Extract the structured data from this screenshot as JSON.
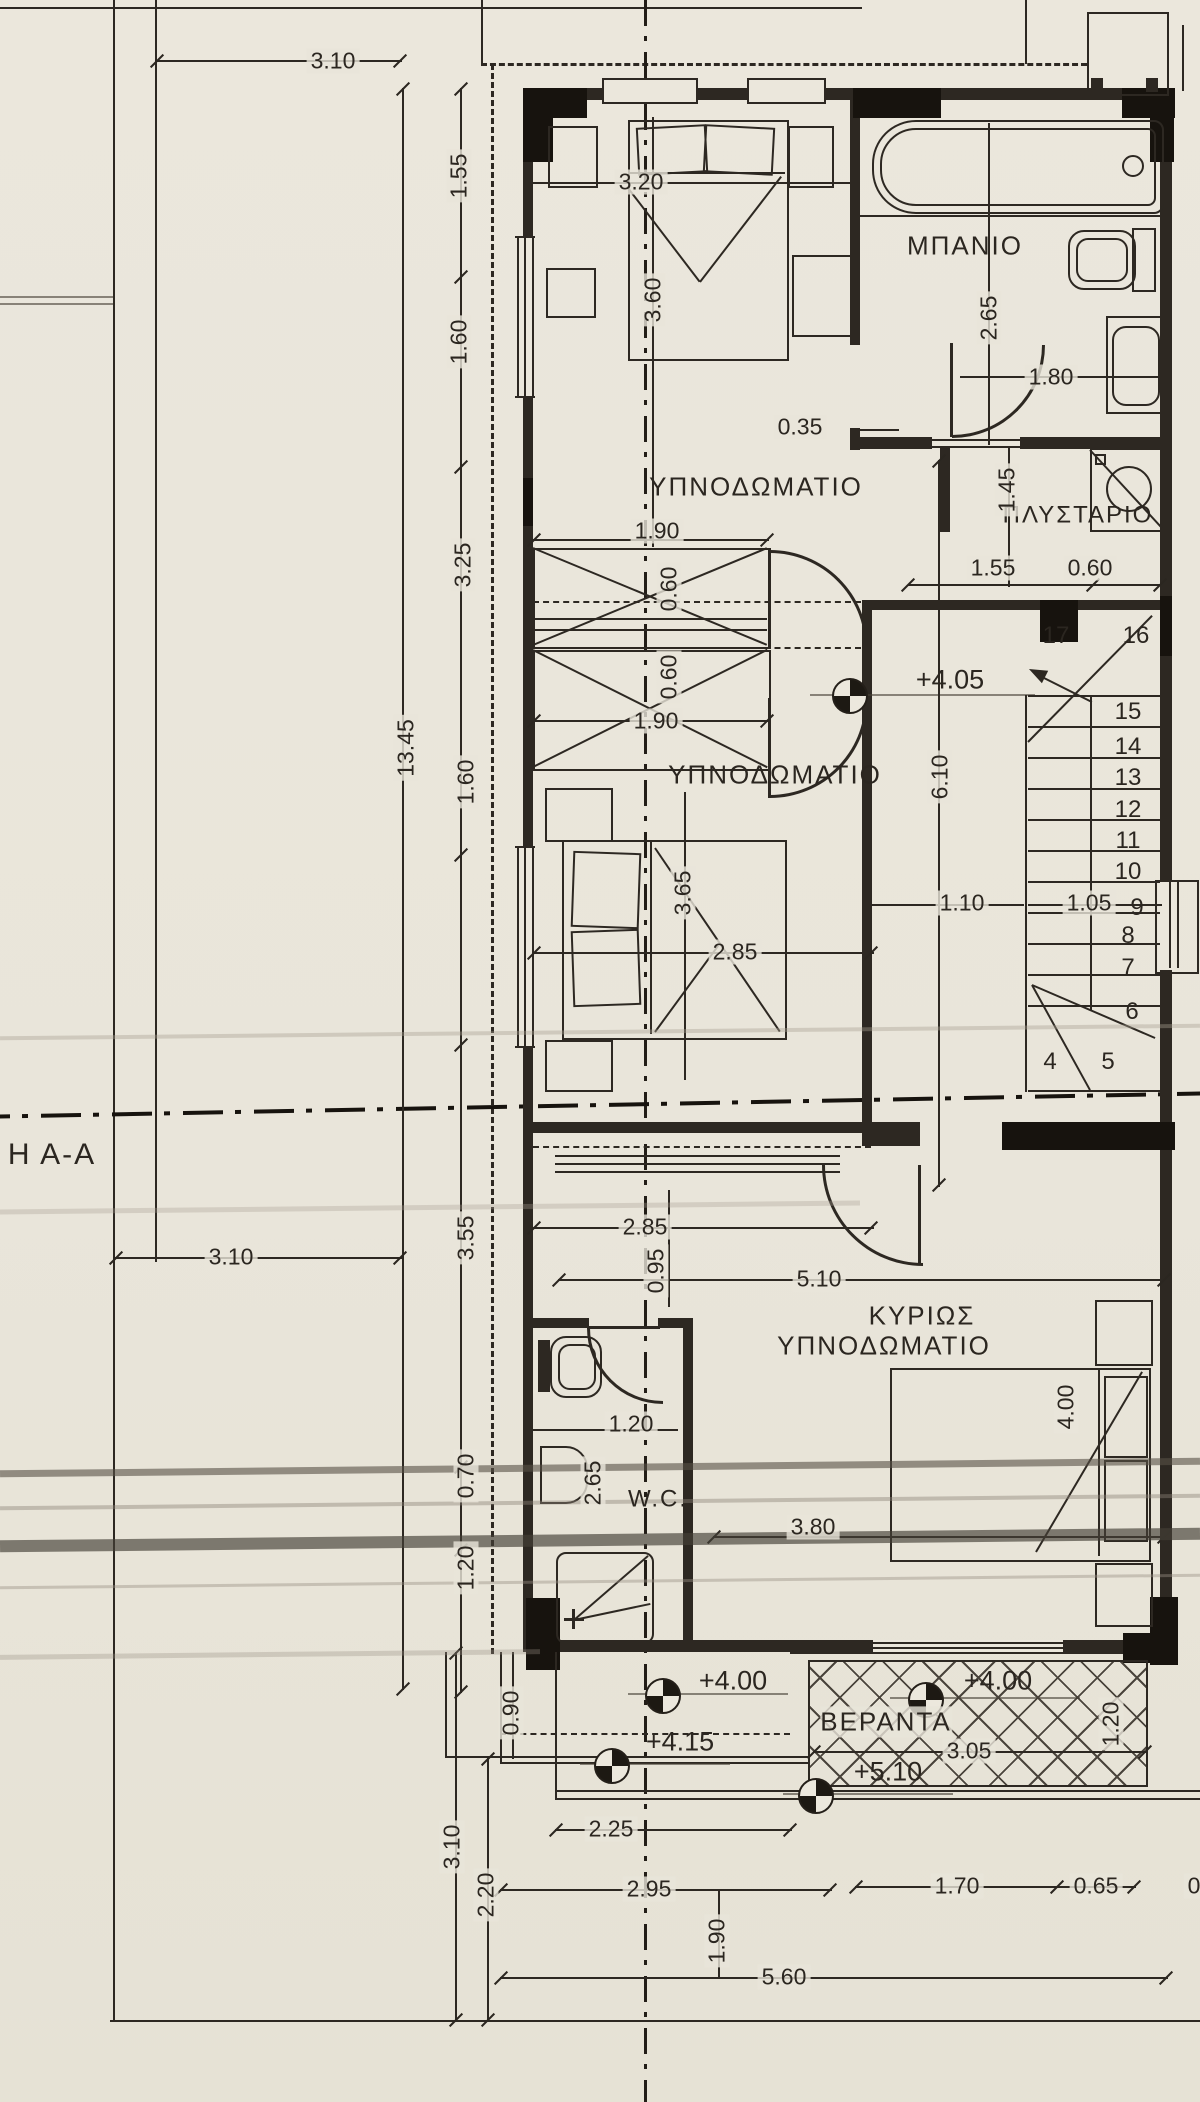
{
  "section_label": "Η Α-Α",
  "rooms": {
    "bedroom_top": "ΥΠΝΟΔΩΜΑΤΙΟ",
    "bedroom_mid": "ΥΠΝΟΔΩΜΑΤΙΟ",
    "bathroom": "ΜΠΑΝΙΟ",
    "laundry": "ΠΛΥΣΤΑΡΙΟ",
    "main_bedroom_line1": "ΚΥΡΙΩΣ",
    "main_bedroom_line2": "ΥΠΝΟΔΩΜΑΤΙΟ",
    "wc": "W.C.",
    "veranda": "ΒΕΡΑΝΤΑ"
  },
  "levels": {
    "hall": "+4.05",
    "exterior": "+4.00",
    "exterior_step": "+4.15",
    "veranda": "+4.00",
    "veranda_lower": "+5.10"
  },
  "stairs": [
    "4",
    "5",
    "6",
    "7",
    "8",
    "9",
    "10",
    "11",
    "12",
    "13",
    "14",
    "15",
    "16",
    "17"
  ],
  "dims": {
    "top_width": "3.10",
    "chain_1_55": "1.55",
    "chain_1_60a": "1.60",
    "chain_3_25": "3.25",
    "chain_13_45": "13.45",
    "chain_1_60b": "1.60",
    "chain_3_55": "3.55",
    "chain_0_70": "0.70",
    "chain_1_20": "1.20",
    "left_bottom": "3.10",
    "bed1_width": "3.20",
    "bed1_length": "3.60",
    "bath_depth": "2.65",
    "bath_width": "1.80",
    "wall_nib": "0.35",
    "laundry_depth": "1.45",
    "laundry_width": "1.55",
    "laundry_right": "0.60",
    "closet1_width": "1.90",
    "closet1_depth": "0.60",
    "closet2_depth": "0.60",
    "closet2_width": "1.90",
    "bed2_length": "3.65",
    "bedroom2_width": "2.85",
    "stair_length": "6.10",
    "hall_width": "1.10",
    "stair_width": "1.05",
    "hall_lower_width": "2.85",
    "hall_lower_depth": "0.95",
    "main_width": "5.10",
    "main_inner": "3.80",
    "main_bed_length": "4.00",
    "wc_depth": "2.65",
    "wc_width": "1.20",
    "ext_steps": "0.90",
    "veranda_width": "3.05",
    "veranda_depth": "1.20",
    "bottom_2_25": "2.25",
    "bottom_2_95": "2.95",
    "bottom_1_90": "1.90",
    "bottom_5_60": "5.60",
    "bottom_1_70": "1.70",
    "bottom_0_65": "0.65",
    "bottom_partial": "0",
    "ll_3_10": "3.10",
    "ll_2_20": "2.20"
  }
}
